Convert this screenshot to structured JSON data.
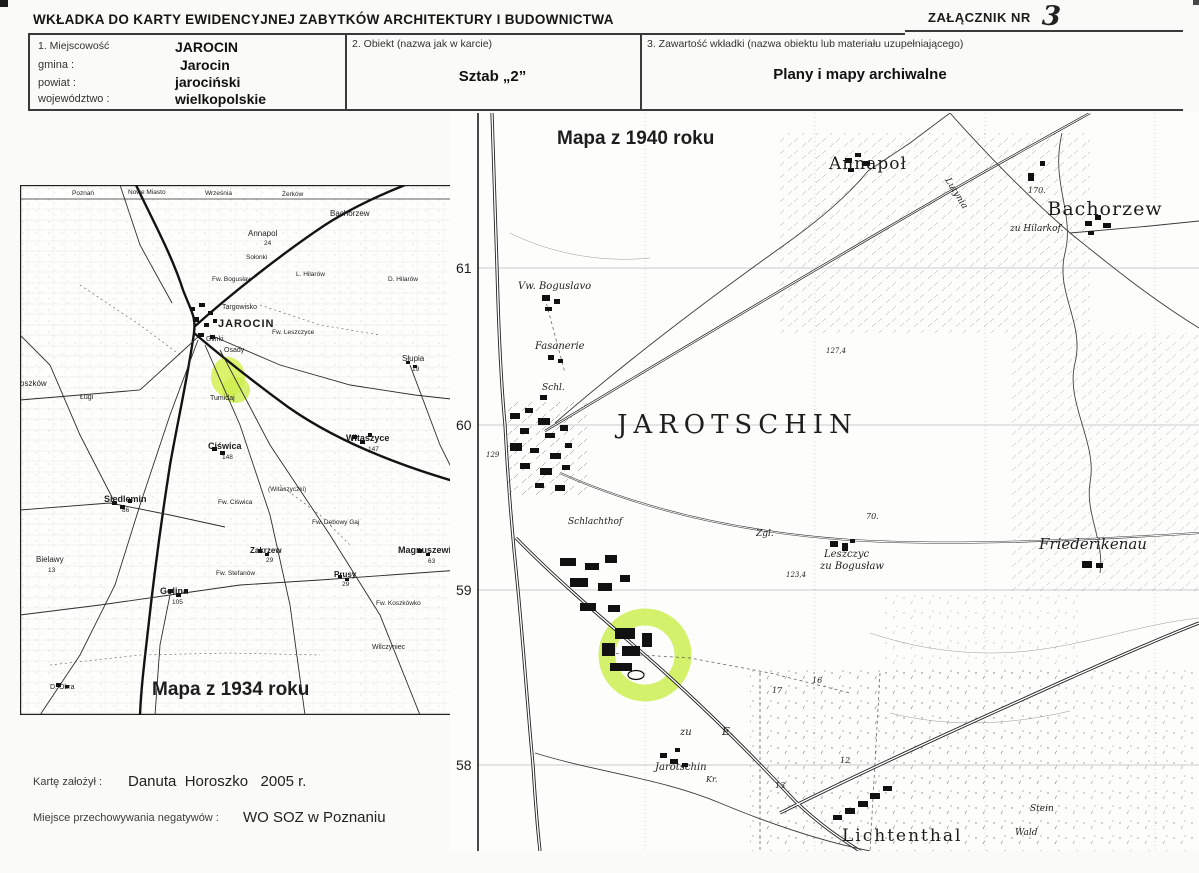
{
  "document": {
    "title": "WKŁADKA DO KARTY EWIDENCYJNEJ ZABYTKÓW ARCHITEKTURY I BUDOWNICTWA",
    "attachment_label": "ZAŁĄCZNIK NR",
    "attachment_number": "3",
    "fields": {
      "f1_label": "1. Miejscowość",
      "f1_value": "JAROCIN",
      "gmina_label": "gmina :",
      "gmina_value": "Jarocin",
      "powiat_label": "powiat :",
      "powiat_value": "jarociński",
      "woj_label": "województwo :",
      "woj_value": "wielkopolskie",
      "f2_label": "2. Obiekt (nazwa jak w karcie)",
      "f2_value": "Sztab „2”",
      "f3_label": "3. Zawartość wkładki (nazwa obiektu lub materiału uzupełniającego)",
      "f3_value": "Plany i mapy archiwalne"
    },
    "footer": {
      "founder_label": "Kartę założył :",
      "founder_value": "Danuta  Horoszko   2005 r.",
      "negatives_label": "Miejsce przechowywania negatywów :",
      "negatives_value": "WO SOZ w Poznaniu"
    }
  },
  "colors": {
    "highlight_green": "#cdee4e",
    "ink": "#1c1c1c"
  },
  "map1934": {
    "caption": "Mapa z 1934 roku",
    "places": {
      "poznan": "Poznań",
      "nowe_miasto": "Nowe Miasto",
      "wrzesnia": "Września",
      "zerkow": "Żerków",
      "bachorzew": "Bachorzew",
      "annapol": "Annapol",
      "annapol_no": "24",
      "solonki": "Sołonki",
      "fw_boguslaw": "Fw. Bogusław",
      "l_hilarow": "L. Hilarów",
      "d_hilarow": "D. Hilarów",
      "targowisko": "Targowisko",
      "jarocin": "JAROCIN",
      "glinki": "Glinki",
      "osady": "Osady",
      "fw_leszczyce": "Fw. Leszczyce",
      "slupia": "Słupia",
      "slupia_no": "19",
      "lugi": "Ługi",
      "roszkow": "oszków",
      "tumidaj": "Tumidaj",
      "witaszyce": "Witaszyce",
      "witaszyce_no": "147",
      "witaszyczki": "(Witaszyczki)",
      "ciswica": "Ciświca",
      "ciswica_no": "148",
      "fw_ciswica": "Fw. Ciświca",
      "siedlemin": "Siedlemin",
      "siedlemin_no": "86",
      "fw_debowy_gaj": "Fw. Dębowy Gaj",
      "magnuszewic": "Magnuszewic",
      "magnuszewic_no": "63",
      "zakrzew": "Zakrzew",
      "zakrzew_no": "29",
      "bielawy": "Bielawy",
      "bielawy_no": "13",
      "prusy": "Prusy",
      "prusy_no": "29",
      "fw_stefanow": "Fw. Stefanów",
      "fw_koszkowko": "Fw. Koszkówko",
      "golina": "Golina",
      "golina_no": "105",
      "wilczyniec": "Wilczyniec",
      "d_obra": "D. Obra"
    }
  },
  "map1940": {
    "caption": "Mapa z 1940 roku",
    "grid": [
      "61",
      "60",
      "59",
      "58"
    ],
    "places": {
      "annapol": "Annapoł",
      "bachorzew": "Bachorzew",
      "zu_hilarkof": "zu Hilarkof.",
      "lutynia": "Lutynia",
      "vw_boguslavo": "Vw. Boguslavo",
      "fasanerie": "Fasanerie",
      "schl": "Schl.",
      "jarotschin": "JAROTSCHIN",
      "schlachthof": "Schlachthof",
      "zgl": "Zgl.",
      "leszczyc1": "Leszczyc",
      "leszczyc2": "zu Bogusław",
      "friederikenau": "Friederikenau",
      "zu": "zu",
      "e": "E.",
      "jarotschin_vil": "Jarotschin",
      "kr": "Kr.",
      "lichtenthal": "Lichtenthal",
      "stein": "Stein",
      "wald": "Wald",
      "n170": "170.",
      "n70": "70.",
      "n127": "127,4",
      "n123": "123,4",
      "n129": "129",
      "n17": "17",
      "n16": "16",
      "n13": "13",
      "n12": "12"
    }
  }
}
